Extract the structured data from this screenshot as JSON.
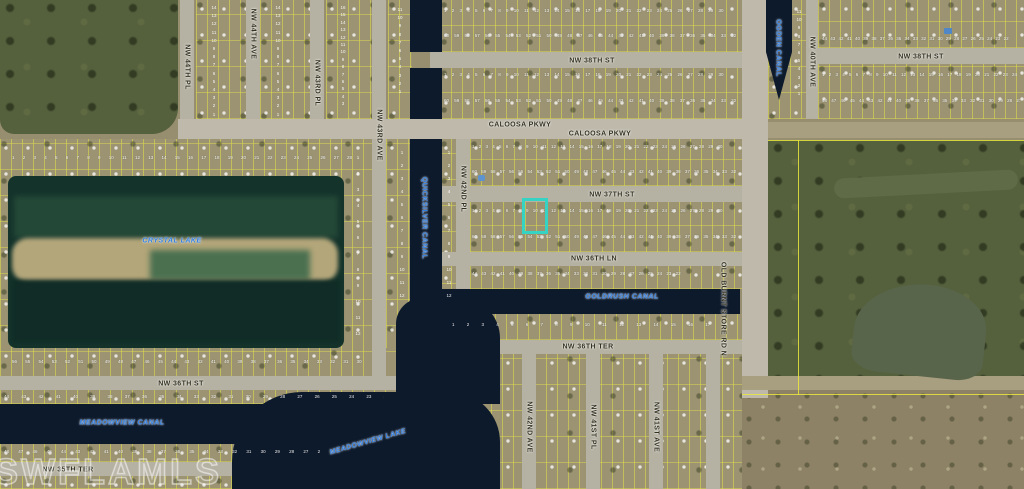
{
  "map": {
    "watermark": "SWFLAMLS",
    "highlight_parcel_color": "#35d3c3",
    "water_label_color": "#2e7de2",
    "street_label_color": "#32301f",
    "streets": {
      "caloosa_pkwy": "CALOOSA PKWY",
      "nw_38th_st": "NW 38TH ST",
      "nw_37th_st": "NW 37TH ST",
      "nw_36th_ln": "NW 36TH LN",
      "nw_36th_ter": "NW 36TH TER",
      "nw_36th_st": "NW 36TH ST",
      "nw_35th_ter": "NW 35TH TER",
      "nw_44th_pl": "NW 44TH PL",
      "nw_44th_ave": "NW 44TH AVE",
      "nw_43rd_pl": "NW 43RD PL",
      "nw_43rd_ave": "NW 43RD AVE",
      "nw_42nd_pl": "NW 42ND PL",
      "nw_42nd_ave": "NW 42ND AVE",
      "nw_41st_pl": "NW 41ST PL",
      "nw_41st_ave": "NW 41ST AVE",
      "nw_40th_ave": "NW 40TH AVE",
      "old_burnt_store_rd_n": "OLD BURNT STORE RD N"
    },
    "waterways": {
      "crystal_lake": "CRYSTAL LAKE",
      "quicksilver_canal": "QUICKSILVER CANAL",
      "ogden_canal": "OGDEN CANAL",
      "goldrush_canal": "GOLDRUSH CANAL",
      "meadowview_canal": "MEADOWVIEW CANAL",
      "meadowview_lake": "MEADOWVIEW LAKE"
    },
    "lot_numbers": {
      "asc30": "1 2 3 4 5 6 7 8 9 10 11 12 13 14 15 16 17 18 19 20 21 22 23 24 25 26 27 28 29 30",
      "desc60": "60 59 58 57 56 55 54 53 52 51 50 49 48 47 46 45 44 43 42 41 40 39 38 37 36 35 34 33 32 31",
      "asc24": "1 2 3 4 5 6 7 8 9 10 11 12 13 14 15 16 17 18 19 20 21 22 23 24",
      "desc48": "48 47 46 45 44 43 42 41 40 39 38 37 36 35 34 33 32 31 30 29 28 27 26 25",
      "asc18": "1 2 3 4 5 6 7 8 9 10 11 12 13 14 15 16 17 18",
      "desc44": "44 43 42 41 40 39 38 37 36 35 34 33 32 31 30 29 28 27 26 25 24 23 22",
      "asc28": "1 2 3 4 5 6 7 8 9 10 11 12 13 14 15 16 17 18 19 20 21 22 23 24 25 26 27 28",
      "desc56": "56 55 54 53 52 51 50 49 48 47 46 45 44 43 42 41 40 39 38 37 36 35 34 33 32 31 30 29",
      "col14": "14\n13\n12\n11\n10\n9\n8\n7\n6\n5\n4\n3\n2\n1",
      "col16": "16\n15\n14\n13\n12\n11\n10\n9\n8\n7\n6\n5\n4\n3",
      "col12": "1\n2\n3\n4\n5\n6\n7\n8\n9\n10\n11\n12",
      "col11": "11\n10\n9\n8\n7\n6\n5\n4\n3\n2\n1"
    }
  }
}
